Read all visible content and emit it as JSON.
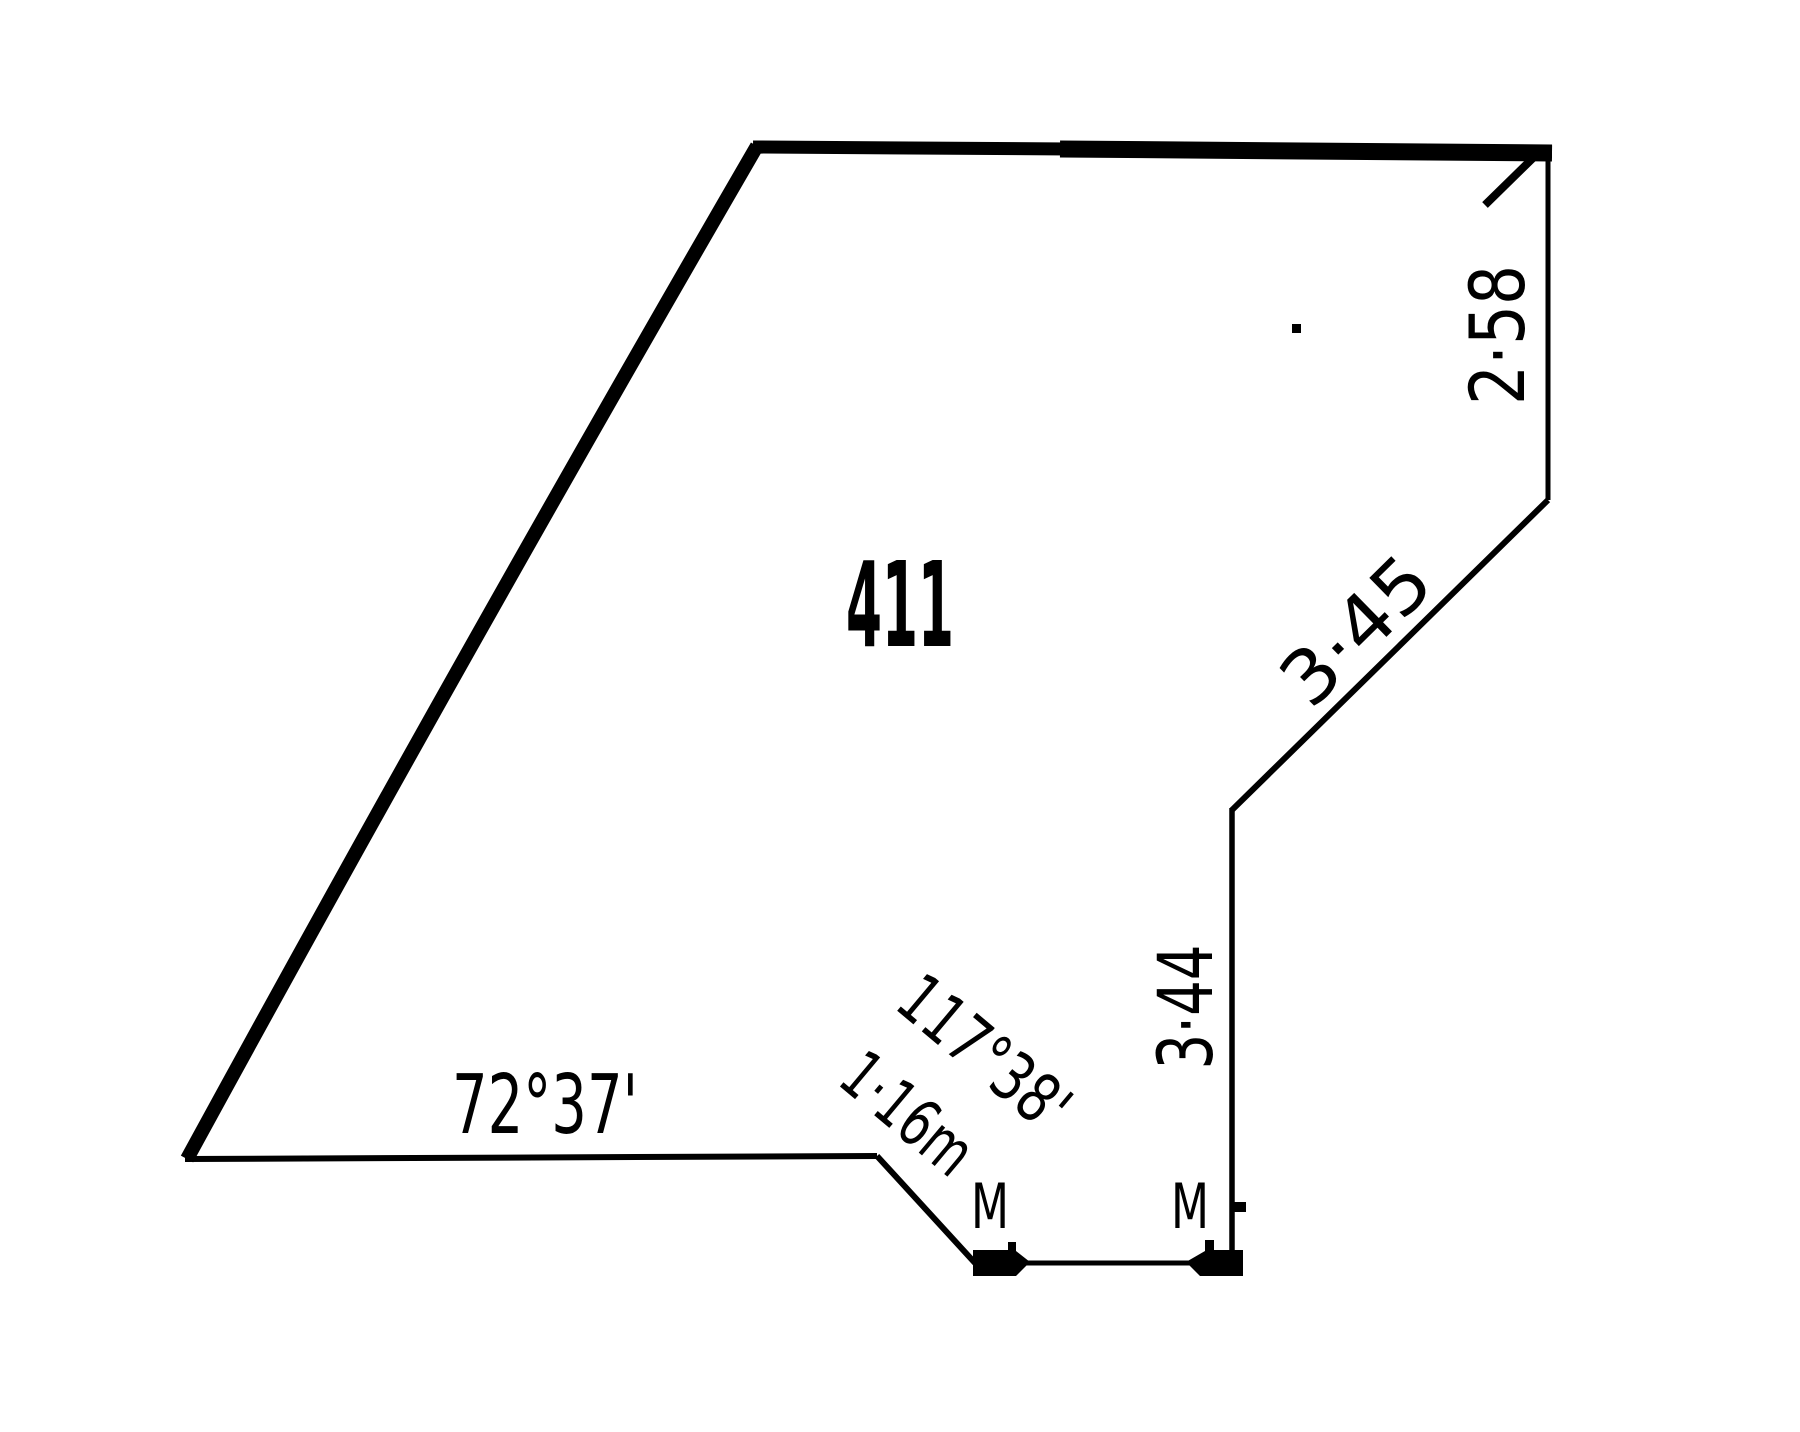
{
  "figure": {
    "type": "survey-parcel-sketch",
    "background": "#ffffff",
    "ink": "#000000",
    "lot_number": "411",
    "bottom_boundary_bearing": "72°37'",
    "splay_bearing": "117°38'",
    "splay_length": "1·16m",
    "east_upper_length": "2·58",
    "diagonal_length": "3·45",
    "east_lower_length": "3·44",
    "mark_left": "M",
    "mark_right": "M"
  }
}
